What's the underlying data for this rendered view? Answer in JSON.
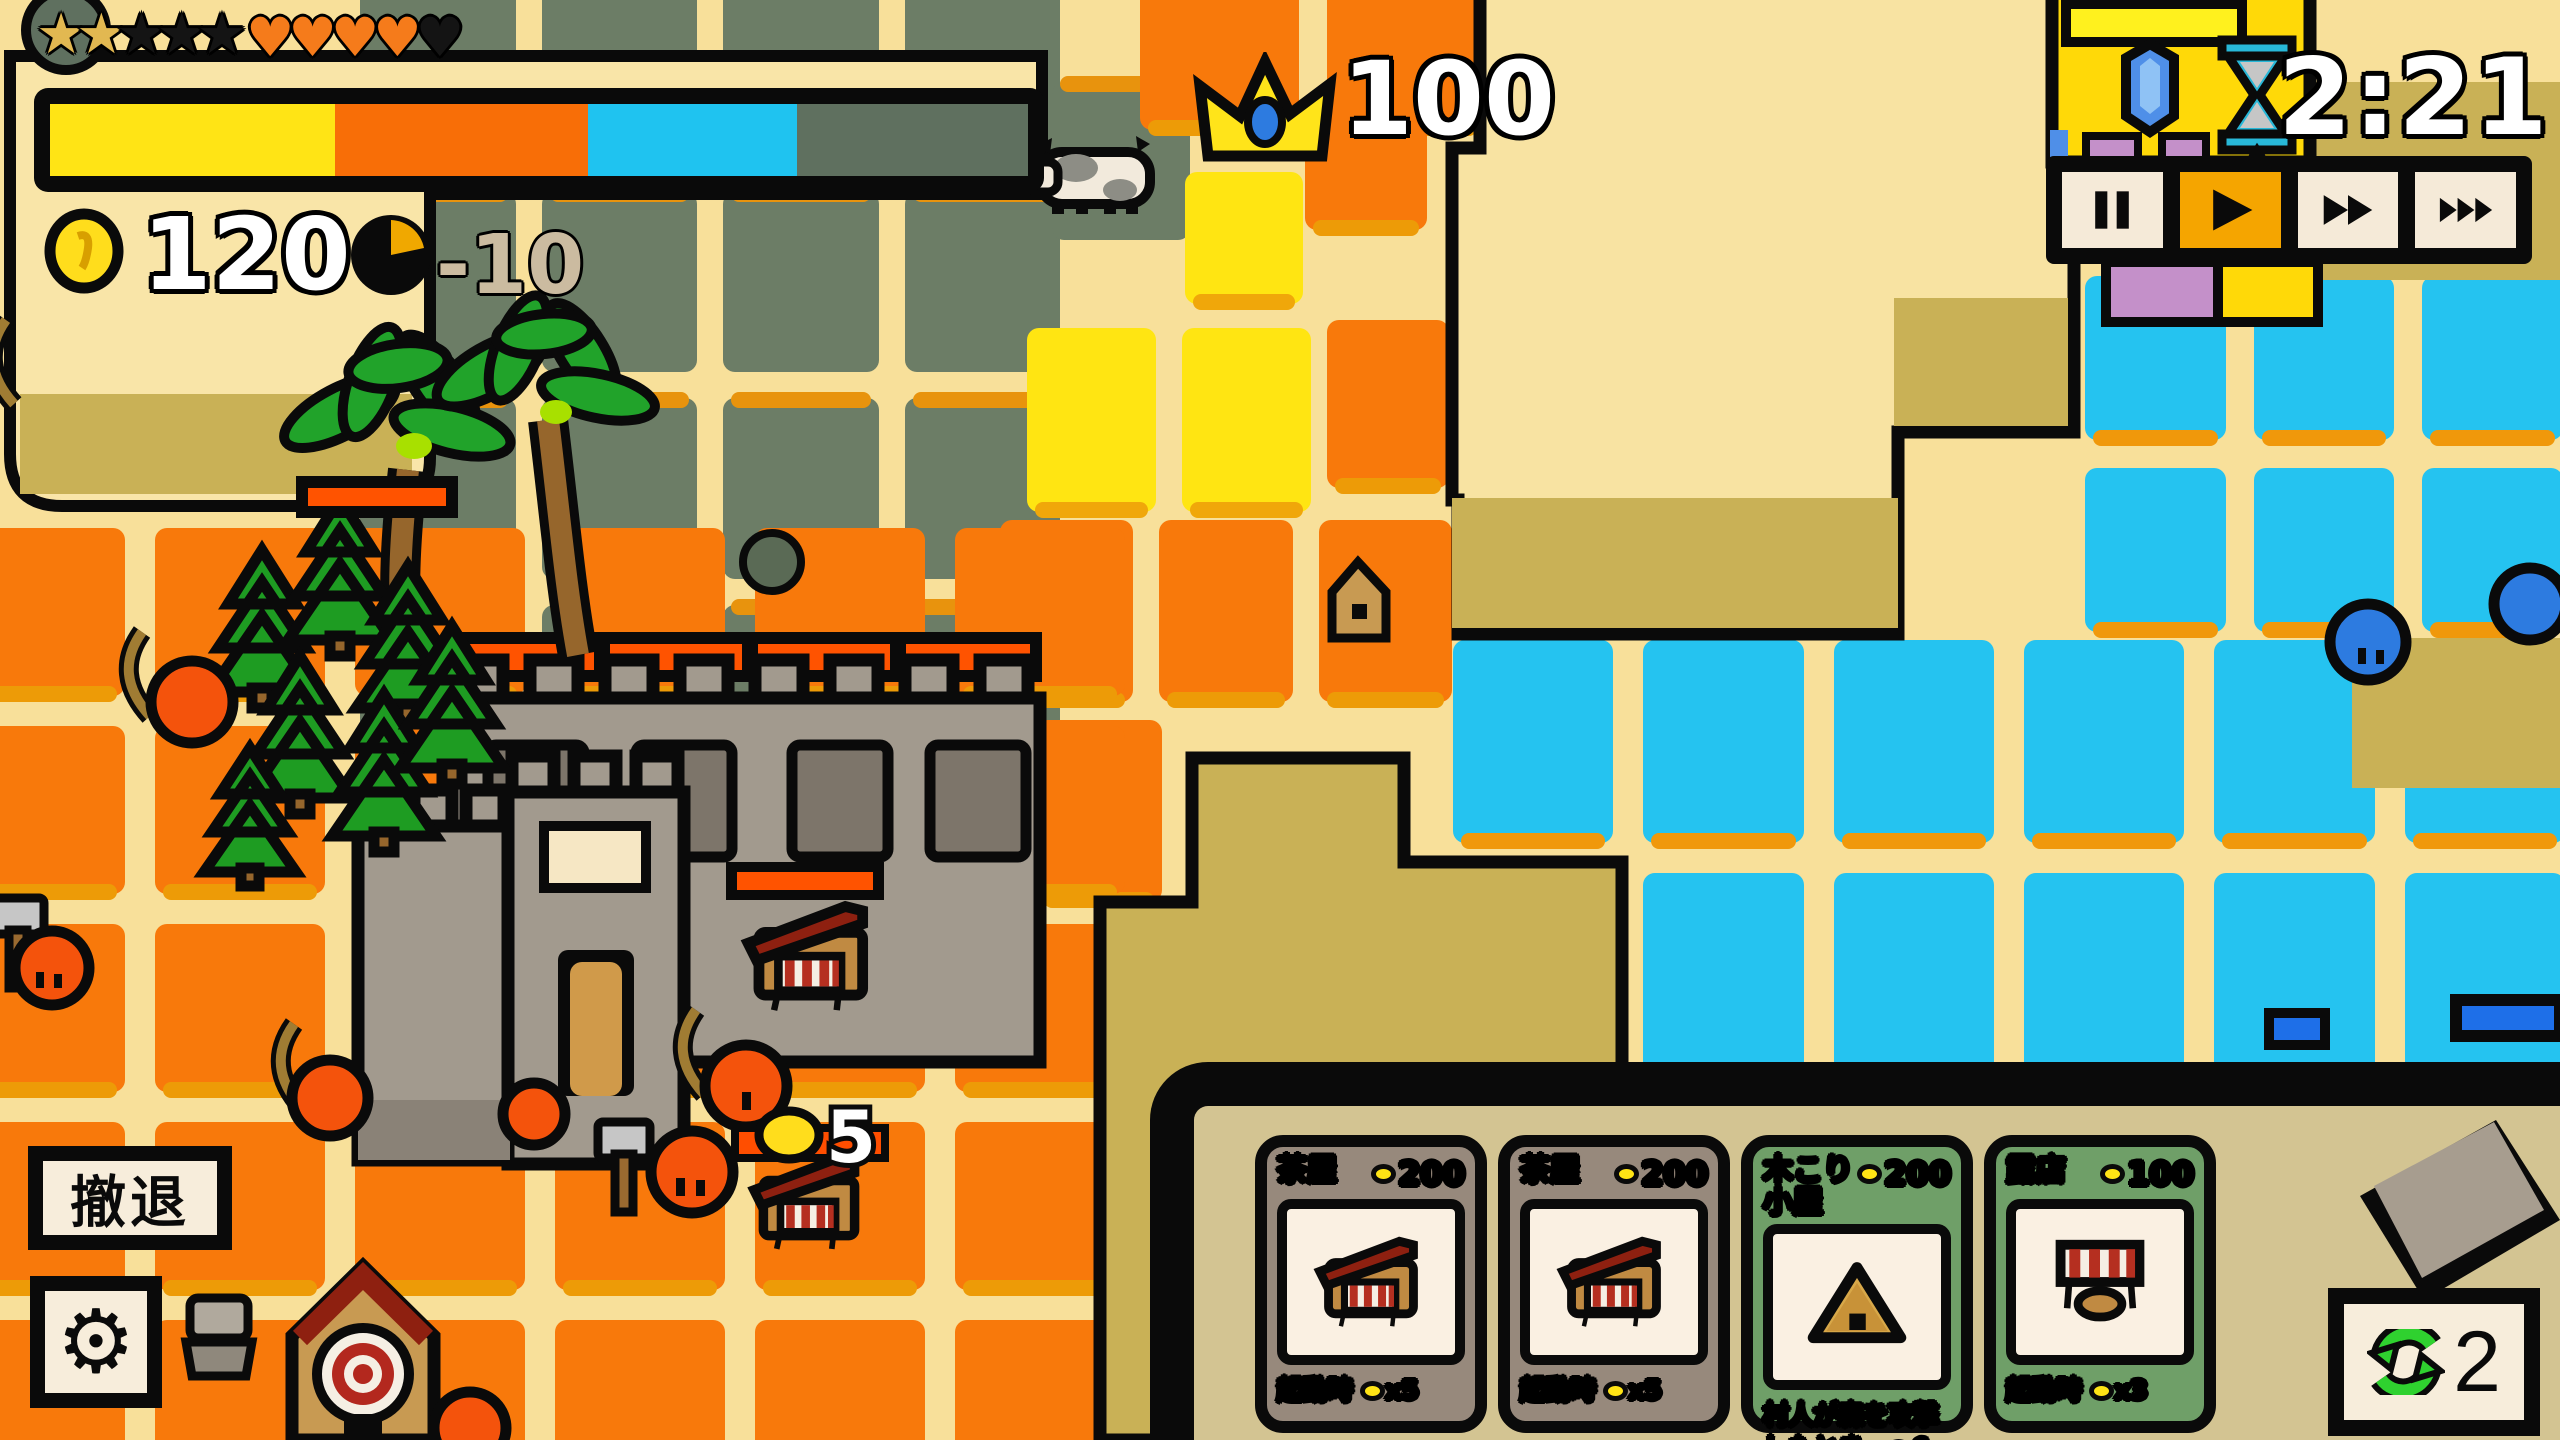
{
  "hud": {
    "stars": {
      "earned": 2,
      "total": 5
    },
    "hearts": {
      "filled": 4,
      "total": 5
    },
    "progress": {
      "segments": [
        {
          "color": "#FFE415",
          "frac": 0.291
        },
        {
          "color": "#F86E07",
          "frac": 0.259
        },
        {
          "color": "#1FC3F0",
          "frac": 0.214
        },
        {
          "color": "#5F705F",
          "frac": 0.236
        }
      ]
    },
    "coins": "120",
    "coin_delta": "-10"
  },
  "score": {
    "crown": "100"
  },
  "timer": {
    "value": "2:21"
  },
  "playback": {
    "active_index": 1,
    "buttons": [
      {
        "id": "pause-button"
      },
      {
        "id": "play-button"
      },
      {
        "id": "fast-forward-2x-button"
      },
      {
        "id": "fast-forward-3x-button"
      }
    ]
  },
  "actions": {
    "retreat": "撤退",
    "reroll": "2"
  },
  "shop_panel": {
    "cards": [
      {
        "title": "茶屋",
        "cost": "200",
        "theme": "#97897C",
        "art": "shop",
        "desc_pre": "起動時 ",
        "desc_post": "x5"
      },
      {
        "title": "茶屋",
        "cost": "200",
        "theme": "#97897C",
        "art": "shop",
        "desc_pre": "起動時 ",
        "desc_post": "x5"
      },
      {
        "title": "木こり小屋",
        "cost": "200",
        "theme": "#6F9F68",
        "art": "hut",
        "desc_pre": "村人が森を攻撃したとき、",
        "desc_post": "6"
      },
      {
        "title": "露店",
        "cost": "100",
        "theme": "#6F9F68",
        "art": "stall",
        "desc_pre": "起動時 ",
        "desc_post": "x3"
      }
    ]
  },
  "map": {
    "unit_coin_label": "5",
    "tile_regions": [
      {
        "color": "#6C7D66",
        "streak": "#E8930D",
        "pos": "top",
        "x": 360,
        "y": -15,
        "w": 700,
        "h": 800,
        "cols": 4,
        "rows": 4,
        "gap": 26
      },
      {
        "color": "#6C7D66",
        "streak": "#E8930D",
        "pos": "top",
        "x": 1052,
        "y": 82,
        "w": 138,
        "h": 158,
        "cols": 1,
        "rows": 1,
        "gap": 26
      },
      {
        "color": "#FFE512",
        "streak": "#F0A70A",
        "pos": "bottom",
        "x": 1185,
        "y": 172,
        "w": 118,
        "h": 132,
        "cols": 1,
        "rows": 1,
        "gap": 26
      },
      {
        "color": "#F8790B",
        "streak": "#ED9B07",
        "pos": "bottom",
        "x": 1140,
        "y": -70,
        "w": 345,
        "h": 200,
        "cols": 2,
        "rows": 1,
        "gap": 28
      },
      {
        "color": "#F8790B",
        "streak": "#ED9B07",
        "pos": "bottom",
        "x": 1305,
        "y": 118,
        "w": 122,
        "h": 112,
        "cols": 1,
        "rows": 1,
        "gap": 26
      },
      {
        "color": "#FFE512",
        "streak": "#F0A70A",
        "pos": "bottom",
        "x": 1027,
        "y": 328,
        "w": 284,
        "h": 184,
        "cols": 2,
        "rows": 1,
        "gap": 26
      },
      {
        "color": "#F8790B",
        "streak": "#ED9B07",
        "pos": "bottom",
        "x": 1327,
        "y": 320,
        "w": 122,
        "h": 168,
        "cols": 1,
        "rows": 1,
        "gap": 26
      },
      {
        "color": "#F8790B",
        "streak": "#ED9B07",
        "pos": "bottom",
        "x": 1000,
        "y": 520,
        "w": 452,
        "h": 182,
        "cols": 3,
        "rows": 1,
        "gap": 26
      },
      {
        "color": "#F8790B",
        "streak": "#ED9B07",
        "pos": "bottom",
        "x": 1036,
        "y": 720,
        "w": 126,
        "h": 182,
        "cols": 1,
        "rows": 1,
        "gap": 26
      },
      {
        "color": "#F8790B",
        "streak": "#ED9B07",
        "pos": "bottom",
        "x": -45,
        "y": 528,
        "w": 1170,
        "h": 960,
        "cols": 6,
        "rows": 5,
        "gap": 30
      },
      {
        "color": "#25C3F0",
        "streak": "#F0980B",
        "pos": "bottom",
        "x": 2085,
        "y": 276,
        "w": 478,
        "h": 356,
        "cols": 3,
        "rows": 2,
        "gap": 28
      },
      {
        "color": "#25C3F0",
        "streak": "#F0980B",
        "pos": "bottom",
        "x": 1453,
        "y": 640,
        "w": 1112,
        "h": 436,
        "cols": 6,
        "rows": 2,
        "gap": 30
      }
    ]
  }
}
